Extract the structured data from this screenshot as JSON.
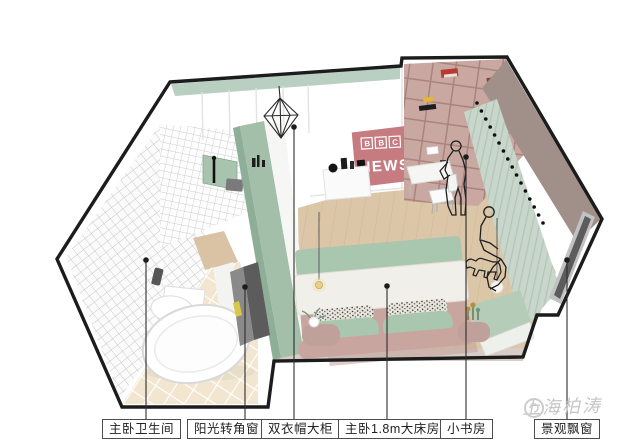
{
  "floorplan": {
    "watermark": "上海柏涛",
    "logo": {
      "bbc_letters": [
        "B",
        "B",
        "C"
      ],
      "news": "NEWS"
    },
    "labels": [
      {
        "id": "master-bathroom",
        "text": "主卧卫生间"
      },
      {
        "id": "sunny-corner-window",
        "text": "阳光转角窗"
      },
      {
        "id": "double-wardrobe",
        "text": "双衣帽大柜"
      },
      {
        "id": "master-bedroom-bed",
        "text": "主卧1.8m大床房"
      },
      {
        "id": "small-study",
        "text": "小书房"
      },
      {
        "id": "scenic-bay-window",
        "text": "景观飘窗"
      }
    ],
    "colors": {
      "outline": "#1c1c1c",
      "logo_bg": "#c57b80",
      "wall_band_green": "#b9cfc2",
      "wardrobe_green": "#a3bfa9",
      "wardrobe_green_dark": "#8fae97",
      "bookshelf_mauve": "#c9a8a1",
      "wood_floor": "#dcc6a8",
      "bath_floor": "#f2e6d0",
      "bed_headboard": "#c8a59e",
      "bed_blanket": "#a9c6af",
      "curtain": "#c8d6cb",
      "right_wall_taupe": "#a18f89",
      "window_glass": "#5c5c5c",
      "watermark_grey": "#c6c6c6"
    }
  }
}
